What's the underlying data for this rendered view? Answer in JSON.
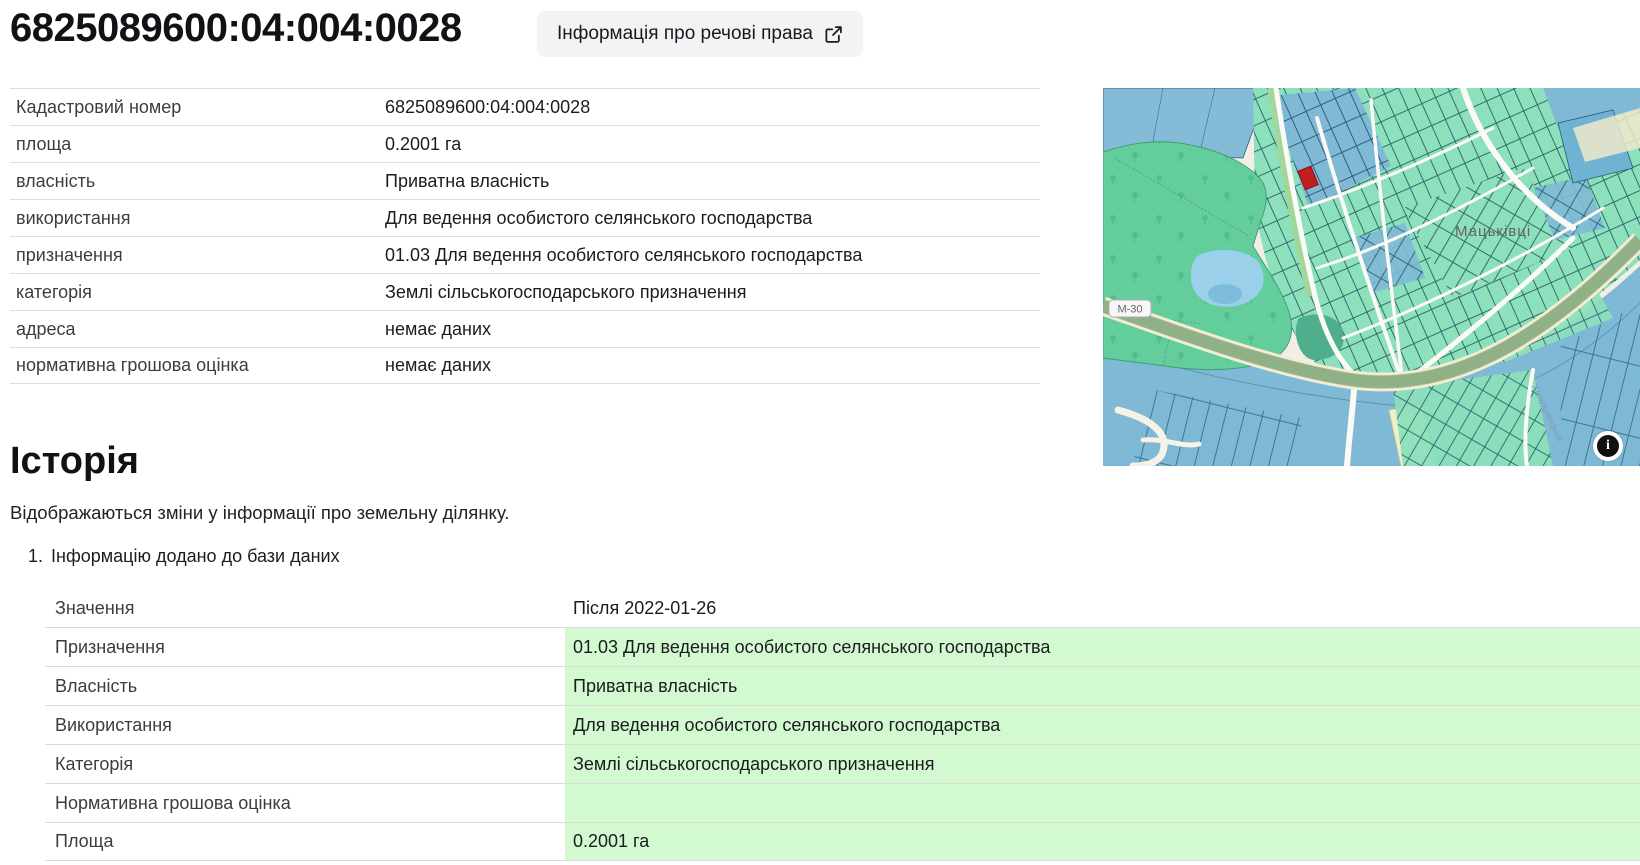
{
  "header": {
    "title": "6825089600:04:004:0028",
    "rights_button_label": "Інформація про речові права"
  },
  "parcel_info": {
    "rows": [
      {
        "label": "Кадастровий номер",
        "value": "6825089600:04:004:0028"
      },
      {
        "label": "площа",
        "value": "0.2001 га"
      },
      {
        "label": "власність",
        "value": "Приватна власність"
      },
      {
        "label": "використання",
        "value": "Для ведення особистого селянського господарства"
      },
      {
        "label": "призначення",
        "value": "01.03 Для ведення особистого селянського господарства"
      },
      {
        "label": "категорія",
        "value": "Землі сільськогосподарського призначення"
      },
      {
        "label": "адреса",
        "value": "немає даних"
      },
      {
        "label": "нормативна грошова оцінка",
        "value": "немає даних"
      }
    ]
  },
  "map": {
    "road_label": "М-30",
    "town_label": "Мацьківці",
    "street_label": "Хмельницька",
    "info_button_glyph": "i",
    "selected_parcel_color": "#c41d1d"
  },
  "history": {
    "heading": "Історія",
    "description": "Відображаються зміни у інформації про земельну ділянку.",
    "items": [
      {
        "number": "1.",
        "title": "Інформацію додано до бази даних",
        "value_header": "Значення",
        "date_header": "Після 2022-01-26",
        "rows": [
          {
            "label": "Призначення",
            "value": "01.03 Для ведення особистого селянського господарства"
          },
          {
            "label": "Власність",
            "value": "Приватна власність"
          },
          {
            "label": "Використання",
            "value": "Для ведення особистого селянського господарства"
          },
          {
            "label": "Категорія",
            "value": "Землі сільськогосподарського призначення"
          },
          {
            "label": "Нормативна грошова оцінка",
            "value": ""
          },
          {
            "label": "Площа",
            "value": "0.2001 га"
          }
        ]
      }
    ]
  },
  "colors": {
    "highlight_green": "#d3f9d0",
    "button_bg": "#f1f3f4",
    "selected_parcel_red": "#c41d1d"
  }
}
